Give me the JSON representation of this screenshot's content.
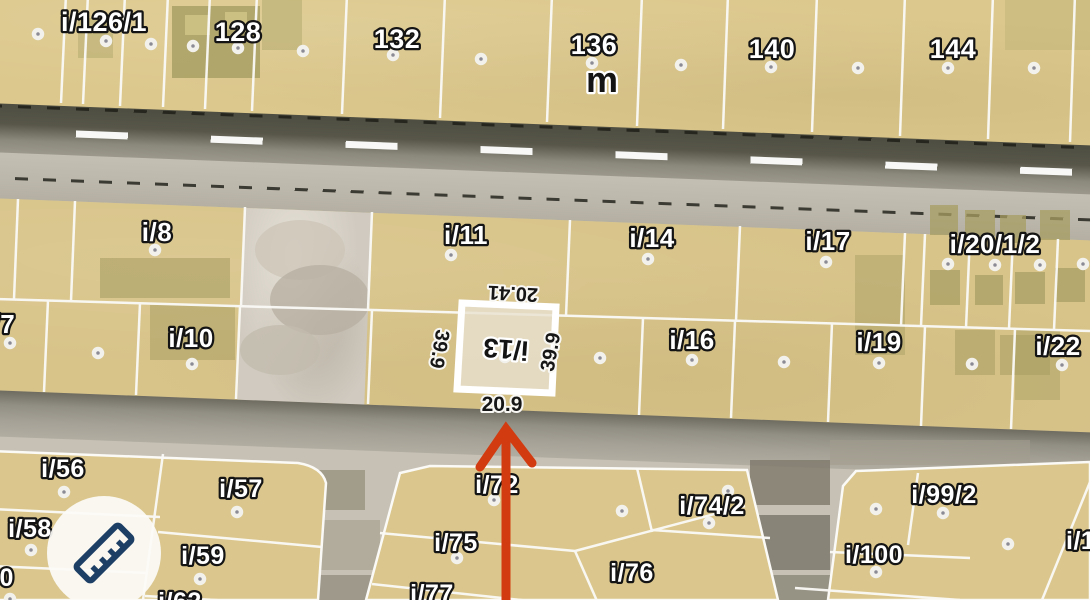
{
  "map_labels": {
    "street": "m",
    "top_row": [
      "i/126/1",
      "128",
      "132",
      "136",
      "140",
      "144"
    ],
    "row_a": [
      "i/8",
      "i/11",
      "i/14",
      "i/17",
      "i/20/1/2"
    ],
    "row_b": [
      "i/7",
      "i/10",
      "i/16",
      "i/19",
      "i/22"
    ],
    "bottom_left": [
      "i/56",
      "i/57",
      "i/58",
      "i/59",
      "i/60",
      "i/62"
    ],
    "bottom_mid": [
      "i/72",
      "i/75",
      "i/77",
      "i/76",
      "i/74/2"
    ],
    "bottom_right": [
      "i/99/2",
      "i/100",
      "i/101"
    ]
  },
  "selected_parcel": {
    "label": "i/13",
    "dim_top": "20.41",
    "dim_left": "39.9",
    "dim_right": "39.9",
    "dim_bottom": "20.9"
  },
  "tools": {
    "measure_button_icon": "ruler-icon"
  },
  "colors": {
    "parcel_fill": "#d9c58c",
    "parcel_boundary": "#fbfaf7",
    "selected_outline": "#ffffff",
    "label_fill": "#ffffff",
    "label_outline": "#141414",
    "dimension_text": "#141414",
    "marker_dot": "#8b8b95",
    "arrow": "#d23b10",
    "road": "#575649",
    "sidewalk": "#bcb7ab",
    "ruler_icon": "#1d3f66"
  }
}
